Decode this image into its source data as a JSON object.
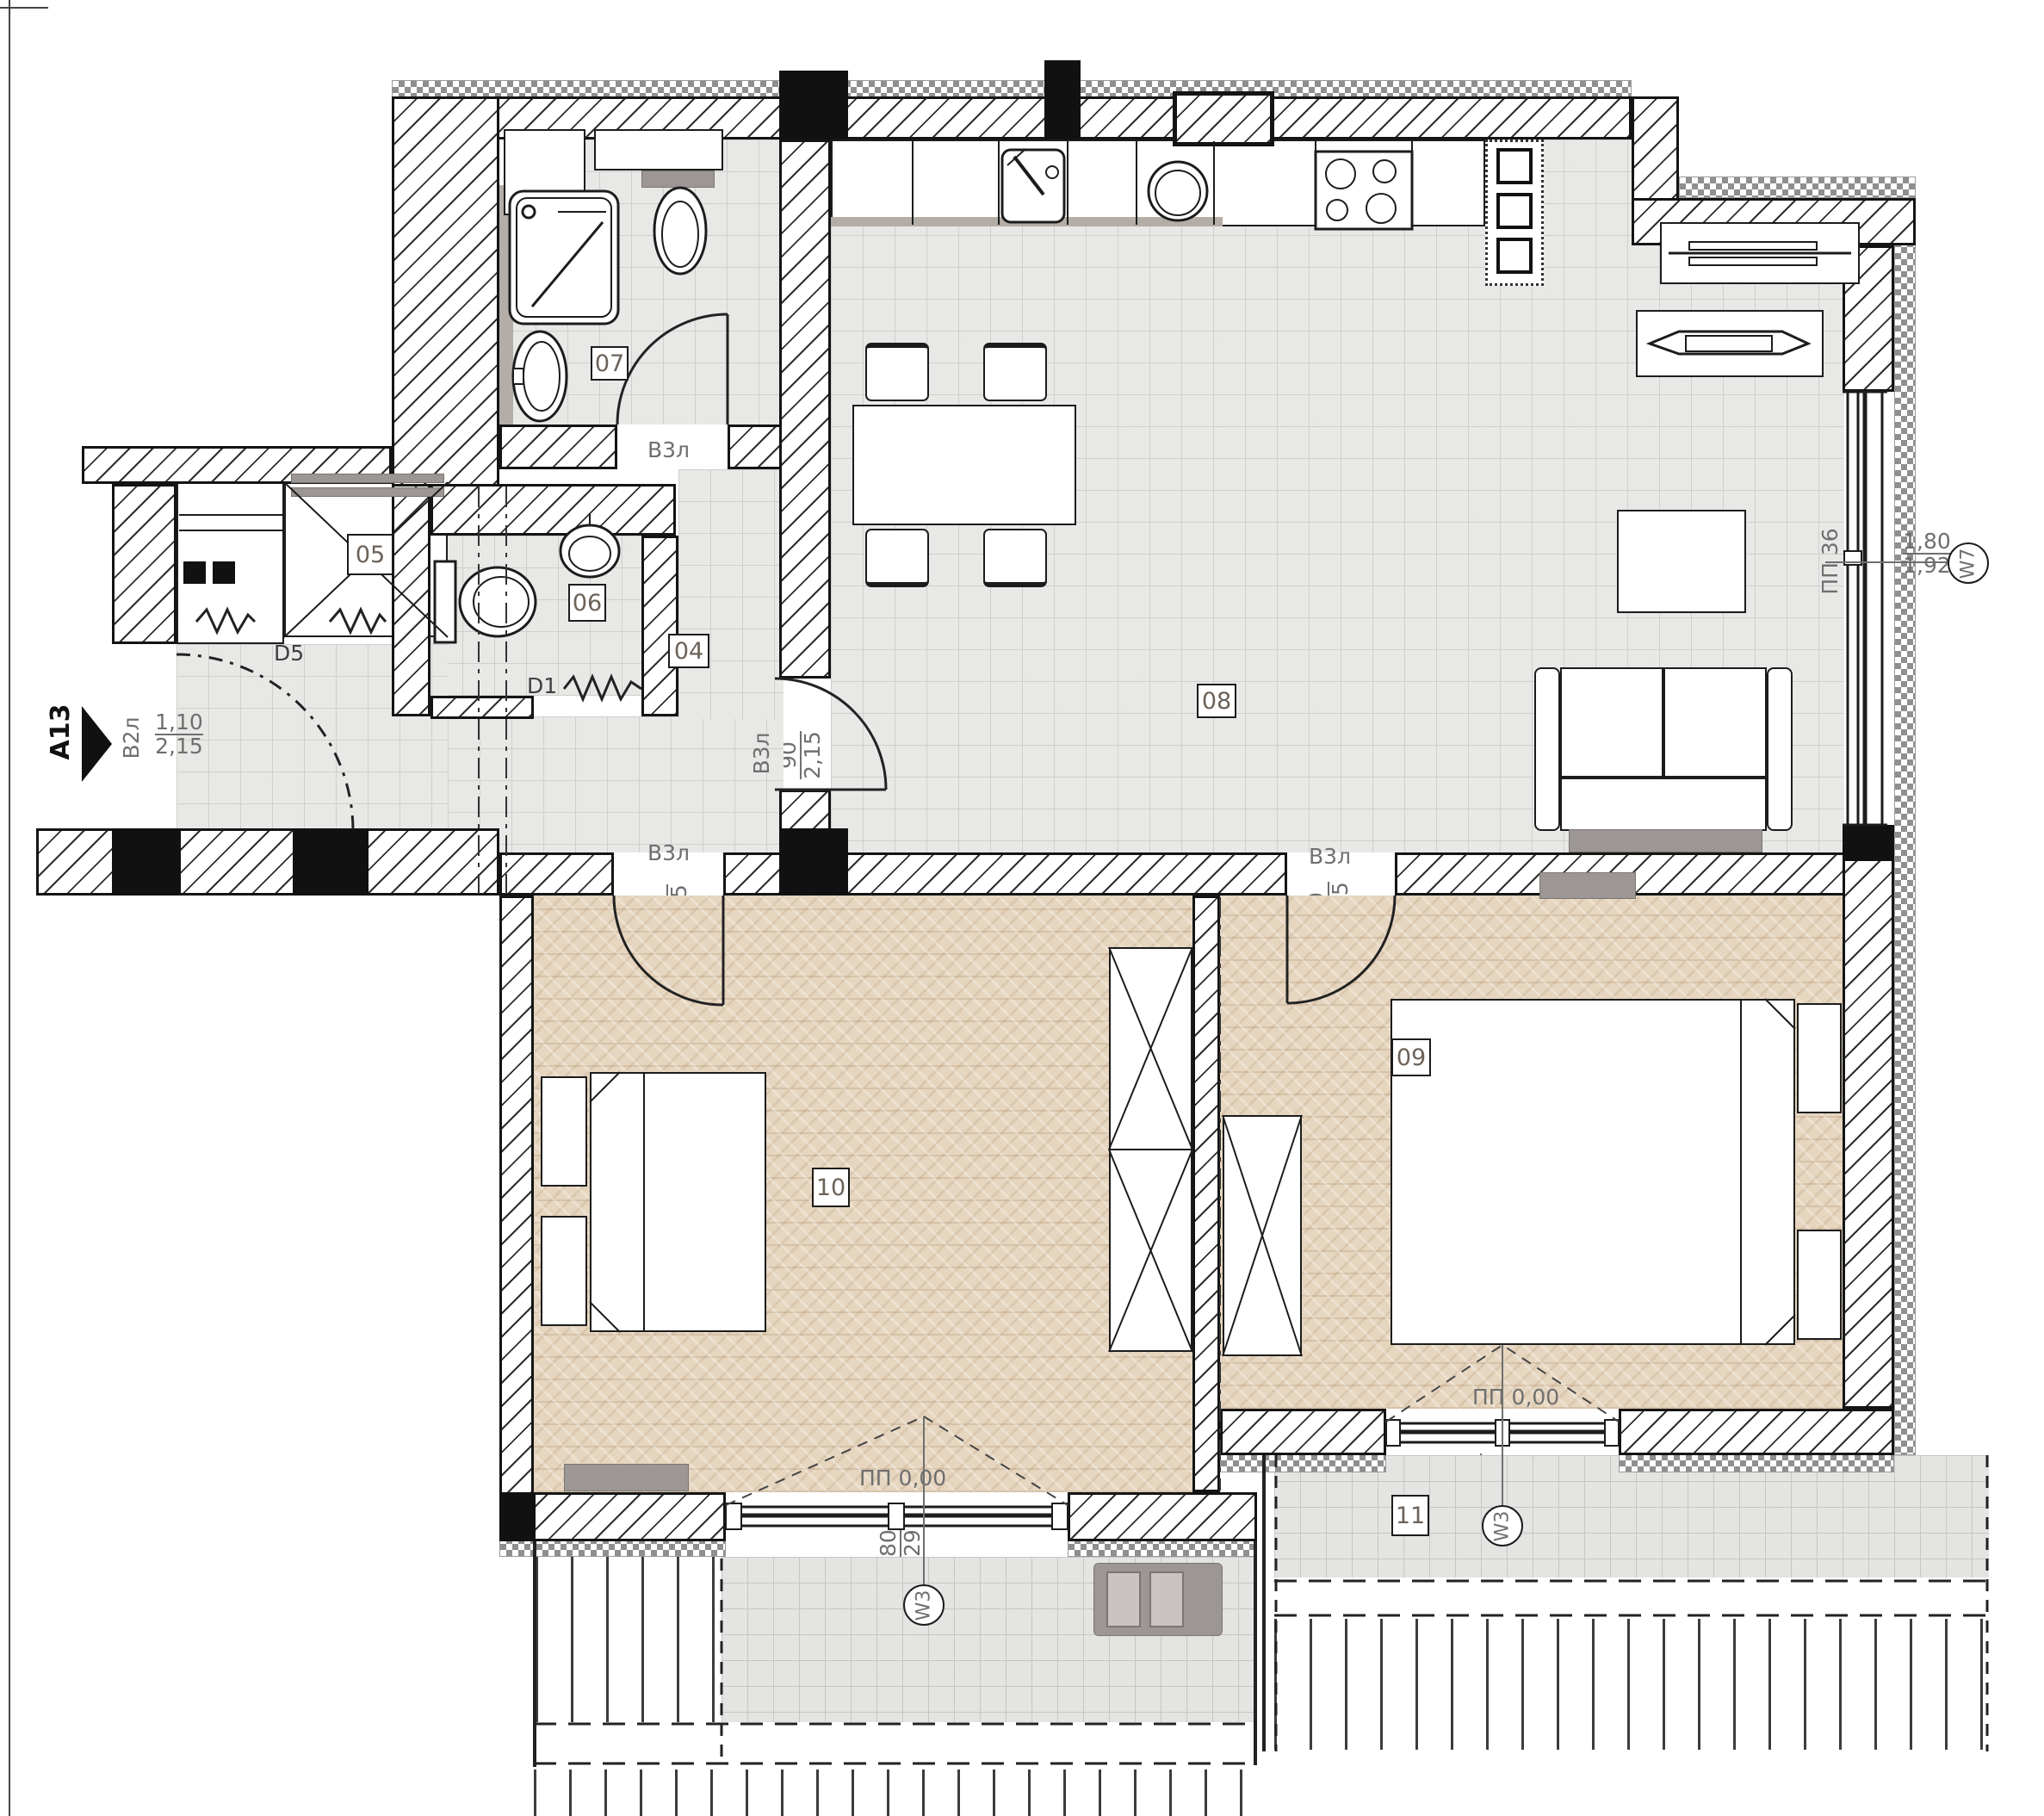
{
  "title": "Apartment A13 floor plan",
  "entrance": {
    "marker": "A13",
    "door_code": "В2л",
    "door_width": "1,10",
    "door_height": "2,15"
  },
  "rooms": {
    "hall": {
      "number": "04"
    },
    "closet": {
      "number": "05"
    },
    "wc": {
      "number": "06"
    },
    "bathroom": {
      "number": "07"
    },
    "living": {
      "number": "08"
    },
    "bedroom2": {
      "number": "09"
    },
    "bedroom1": {
      "number": "10"
    },
    "terrace": {
      "number": "11"
    }
  },
  "doors": {
    "d5": {
      "code": "D5",
      "width": "1,28",
      "height": "2,15"
    },
    "d1": {
      "code": "D1",
      "width": "90",
      "height": "2,15"
    },
    "bathroom": {
      "code": "В3л",
      "width": "90",
      "height": "2,15"
    },
    "living": {
      "code": "В3л",
      "width": "90",
      "height": "2,15"
    },
    "bedroom1": {
      "code": "В3л",
      "width": "90",
      "height": "2,15"
    },
    "bedroom2": {
      "code": "В3л",
      "width": "90",
      "height": "2,15"
    }
  },
  "windows": {
    "living": {
      "code": "W7",
      "sill": "ПП 36",
      "width": "1,80",
      "height": "1,92"
    },
    "bedroom1": {
      "code": "W3",
      "sill": "ПП 0,00",
      "width": "1,80",
      "height": "2,29"
    },
    "bedroom2": {
      "code": "W3",
      "sill": "ПП 0,00",
      "width": "1,80",
      "height": "2,29"
    }
  },
  "colors": {
    "wood_floor": "#e6d6c0",
    "tile_floor": "#e8e8e6",
    "radiator": "#9c9694"
  }
}
